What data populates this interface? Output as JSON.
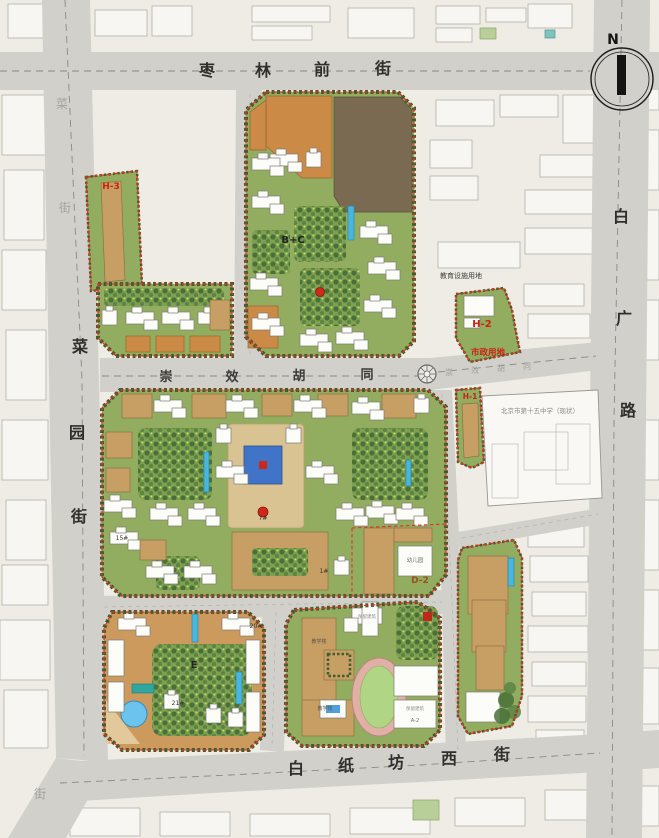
{
  "north": {
    "label": "N"
  },
  "streets": {
    "top": {
      "name": "枣林前街",
      "chars": [
        "枣",
        "林",
        "前",
        "街"
      ]
    },
    "left": {
      "name": "菜园街",
      "chars": [
        "菜",
        "园",
        "街"
      ]
    },
    "right": {
      "name": "白广路",
      "chars": [
        "白",
        "广",
        "路"
      ]
    },
    "middle": {
      "name": "崇效胡同",
      "chars": [
        "崇",
        "效",
        "胡",
        "同"
      ]
    },
    "bottom": {
      "name": "白纸坊西街",
      "chars": [
        "白",
        "纸",
        "坊",
        "西",
        "街"
      ]
    }
  },
  "labels": {
    "h3": "H-3",
    "bc": "B+C",
    "h2": "H-2",
    "municipal": "市政用地",
    "edu": "教育设施用地",
    "h1": "H-1",
    "school": "北京市第十五中学（现状）",
    "kindergarten": "幼儿园",
    "d2": "D-2",
    "e": "E",
    "b15": "15#",
    "b7": "7#",
    "b1": "1#",
    "b20": "20#",
    "b21": "21#",
    "teach1": "教学楼",
    "teach2": "教学楼",
    "retain1": "保留建筑",
    "retain2": "保留建筑",
    "a2": "A-2"
  },
  "colors": {
    "parcel_green": "#93ad60",
    "boundary_red": "#e0321f",
    "road_gray": "#d2d0cb",
    "residential_white": "#fcfcf9",
    "commercial_orange": "#cb8a46",
    "building_tan": "#c79e63",
    "retained_brown": "#7b6a52",
    "water_blue": "#49b6de",
    "track_ring": "#e0b0a7",
    "track_field": "#b0d585"
  }
}
